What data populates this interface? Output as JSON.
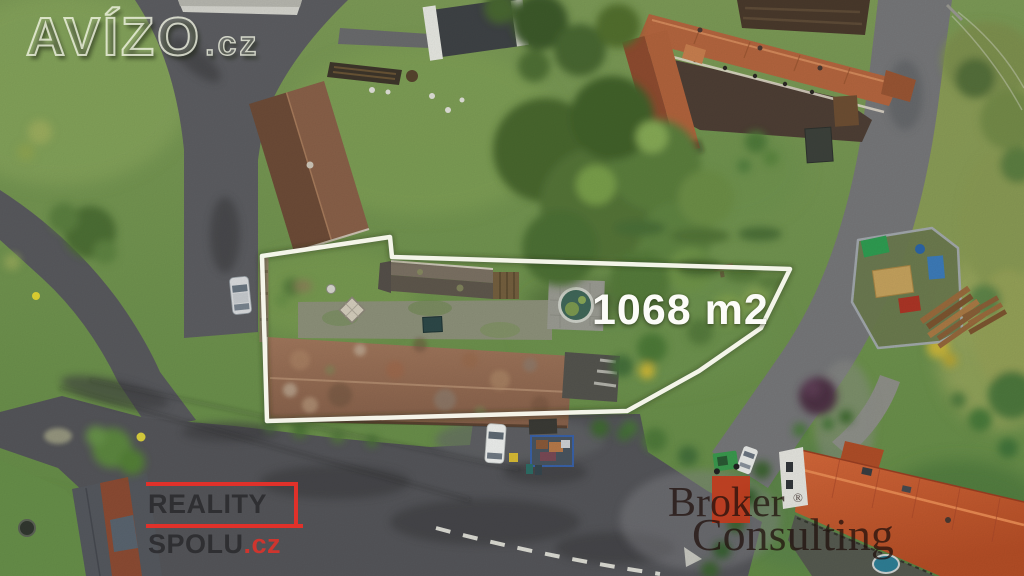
{
  "listing": {
    "area_label": "1068 m2"
  },
  "watermarks": {
    "avizo": {
      "name": "AVÍZO",
      "tld": ".cz"
    },
    "reality_spolu": {
      "line1": "REALITY",
      "line2": "SPOLU",
      "tld": ".cz"
    },
    "broker_consulting": {
      "word1": "Broker",
      "word2": "Consulting",
      "registered": "®"
    }
  },
  "theme": {
    "outline-white": "#fbfbf0",
    "reality-red": "#e0312a",
    "reality-dark": "#2b2b2e",
    "broker-orange": "#c03a1d",
    "broker-ink": "rgba(32,16,12,0.75)",
    "avizo-stroke": "rgba(243,246,230,0.78)",
    "label-white": "#fcfcf8"
  }
}
